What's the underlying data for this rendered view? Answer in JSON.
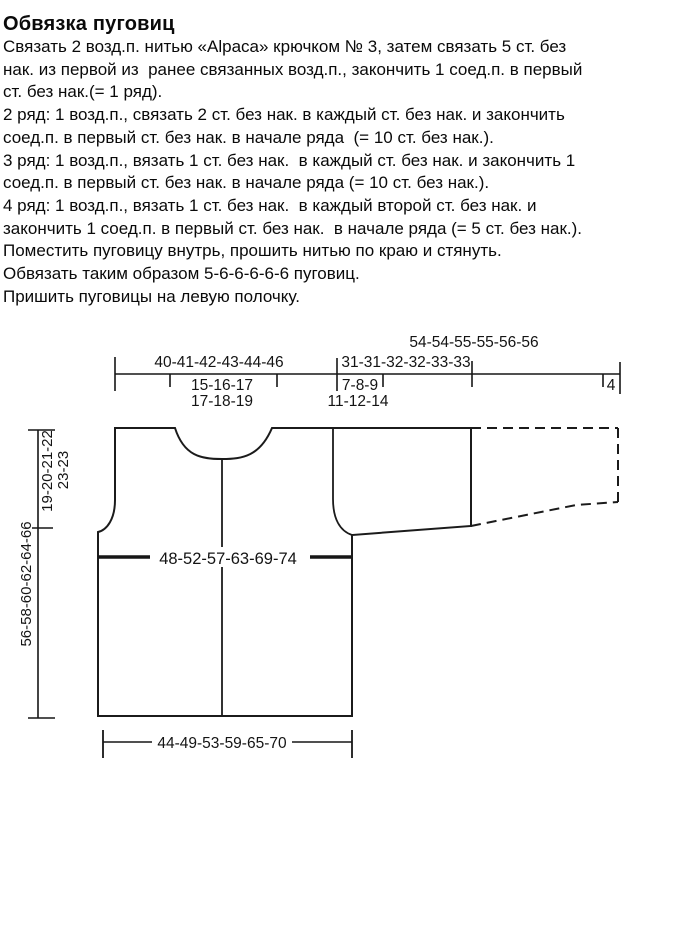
{
  "page": {
    "background": "#ffffff",
    "ink": "#141414"
  },
  "pattern_text": {
    "title": "Обвязка пуговиц",
    "lines": [
      "Связать 2 возд.п. нитью «Alpaca» крючком № 3, затем связать 5 ст. без",
      "нак. из первой из  ранее связанных возд.п., закончить 1 соед.п. в первый",
      "ст. без нак.(= 1 ряд).",
      "2 ряд: 1 возд.п., связать 2 ст. без нак. в каждый ст. без нак. и закончить",
      "соед.п. в первый ст. без нак. в начале ряда  (= 10 ст. без нак.).",
      "3 ряд: 1 возд.п., вязать 1 ст. без нак.  в каждый ст. без нак. и закончить 1",
      "соед.п. в первый ст. без нак. в начале ряда (= 10 ст. без нак.).",
      "4 ряд: 1 возд.п., вязать 1 ст. без нак.  в каждый второй ст. без нак. и",
      "закончить 1 соед.п. в первый ст. без нак.  в начале ряда (= 5 ст. без нак.).",
      "Поместить пуговицу внутрь, прошить нитью по краю и стянуть.",
      "Обвязать таким образом 5-6-6-6-6-6 пуговиц.",
      "Пришить пуговицы на левую полочку."
    ]
  },
  "diagram": {
    "top": {
      "sleeve_total": "54-54-55-55-56-56",
      "back_width": "40-41-42-43-44-46",
      "sleeve_top_width": "31-31-32-32-33-33",
      "shoulder_line1": "15-16-17",
      "shoulder_line2": "17-18-19",
      "neck_line1": "7-8-9",
      "neck_line2": "11-12-14",
      "cuff": "4"
    },
    "left": {
      "armhole_depth_line1": "19-20-21-22",
      "armhole_depth_line2": "23-23",
      "total_length": "56-58-60-62-64-66"
    },
    "body": {
      "chest_width": "48-52-57-63-69-74",
      "hem_width": "44-49-53-59-65-70"
    }
  }
}
